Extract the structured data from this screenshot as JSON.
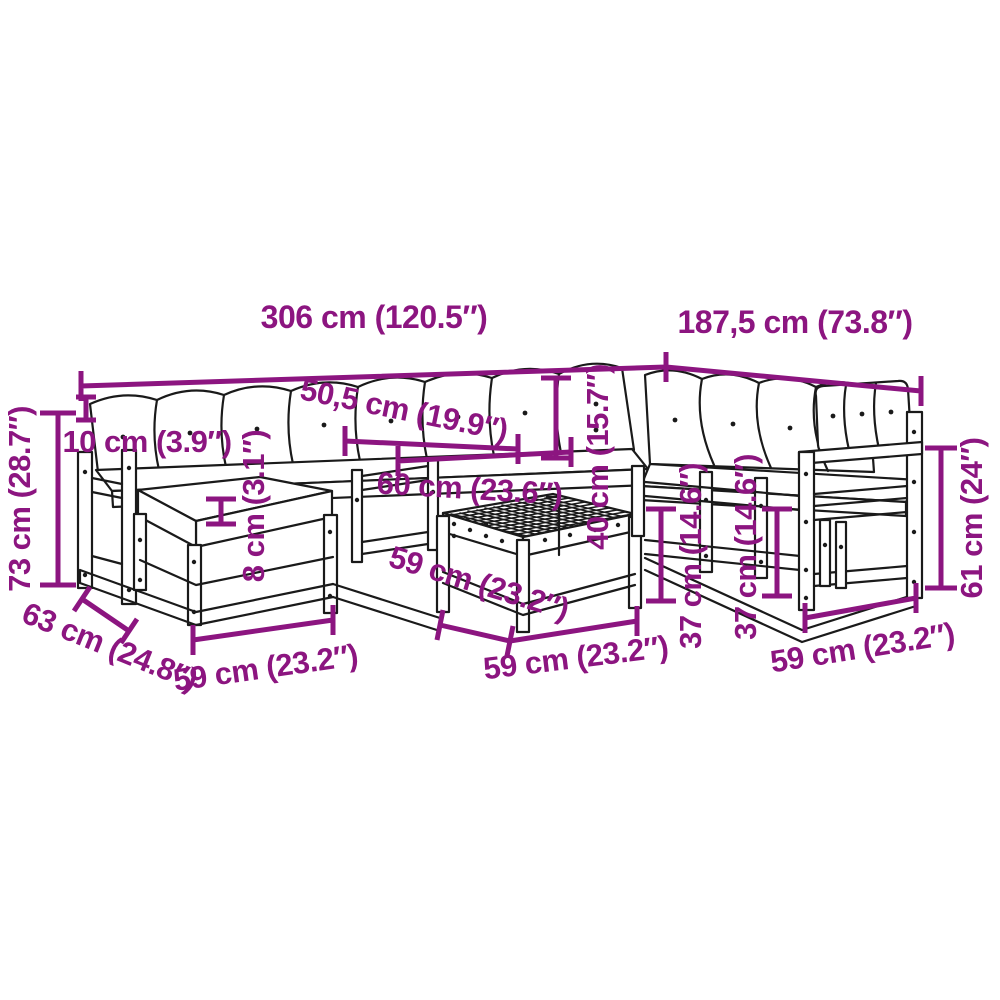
{
  "diagram_type": "furniture dimension diagram",
  "subject": "garden lounge corner sofa set with table, line drawing with measurements",
  "colors": {
    "dimension": "#8C1580",
    "line_art": "#1A1A1A",
    "background": "#FFFFFF"
  },
  "annotations": {
    "width_main": {
      "label": "306 cm (120.5″)"
    },
    "width_right": {
      "label": "187,5 cm (73.8″)"
    },
    "height_total": {
      "label": "73 cm (28.7″)"
    },
    "back_cushion_thickness": {
      "label": "10 cm (3.9″)"
    },
    "back_cushion_width": {
      "label": "50,5 cm (19.9″)"
    },
    "seat_depth": {
      "label": "60 cm (23.6″)"
    },
    "seat_thickness": {
      "label": "8 cm (3.1″)"
    },
    "back_height": {
      "label": "40 cm (15.7″)"
    },
    "frame_height_a": {
      "label": "37 cm (14.6″)"
    },
    "frame_height_b": {
      "label": "37 cm (14.6″)"
    },
    "armchair_height": {
      "label": "61 cm (24″)"
    },
    "module_width_left": {
      "label": "59 cm (23.2″)"
    },
    "module_depth_left": {
      "label": "63 cm (24.8″)"
    },
    "module_depth_mid": {
      "label": "59 cm (23.2″)"
    },
    "table_width": {
      "label": "59 cm (23.2″)"
    },
    "module_width_right": {
      "label": "59 cm (23.2″)"
    }
  }
}
